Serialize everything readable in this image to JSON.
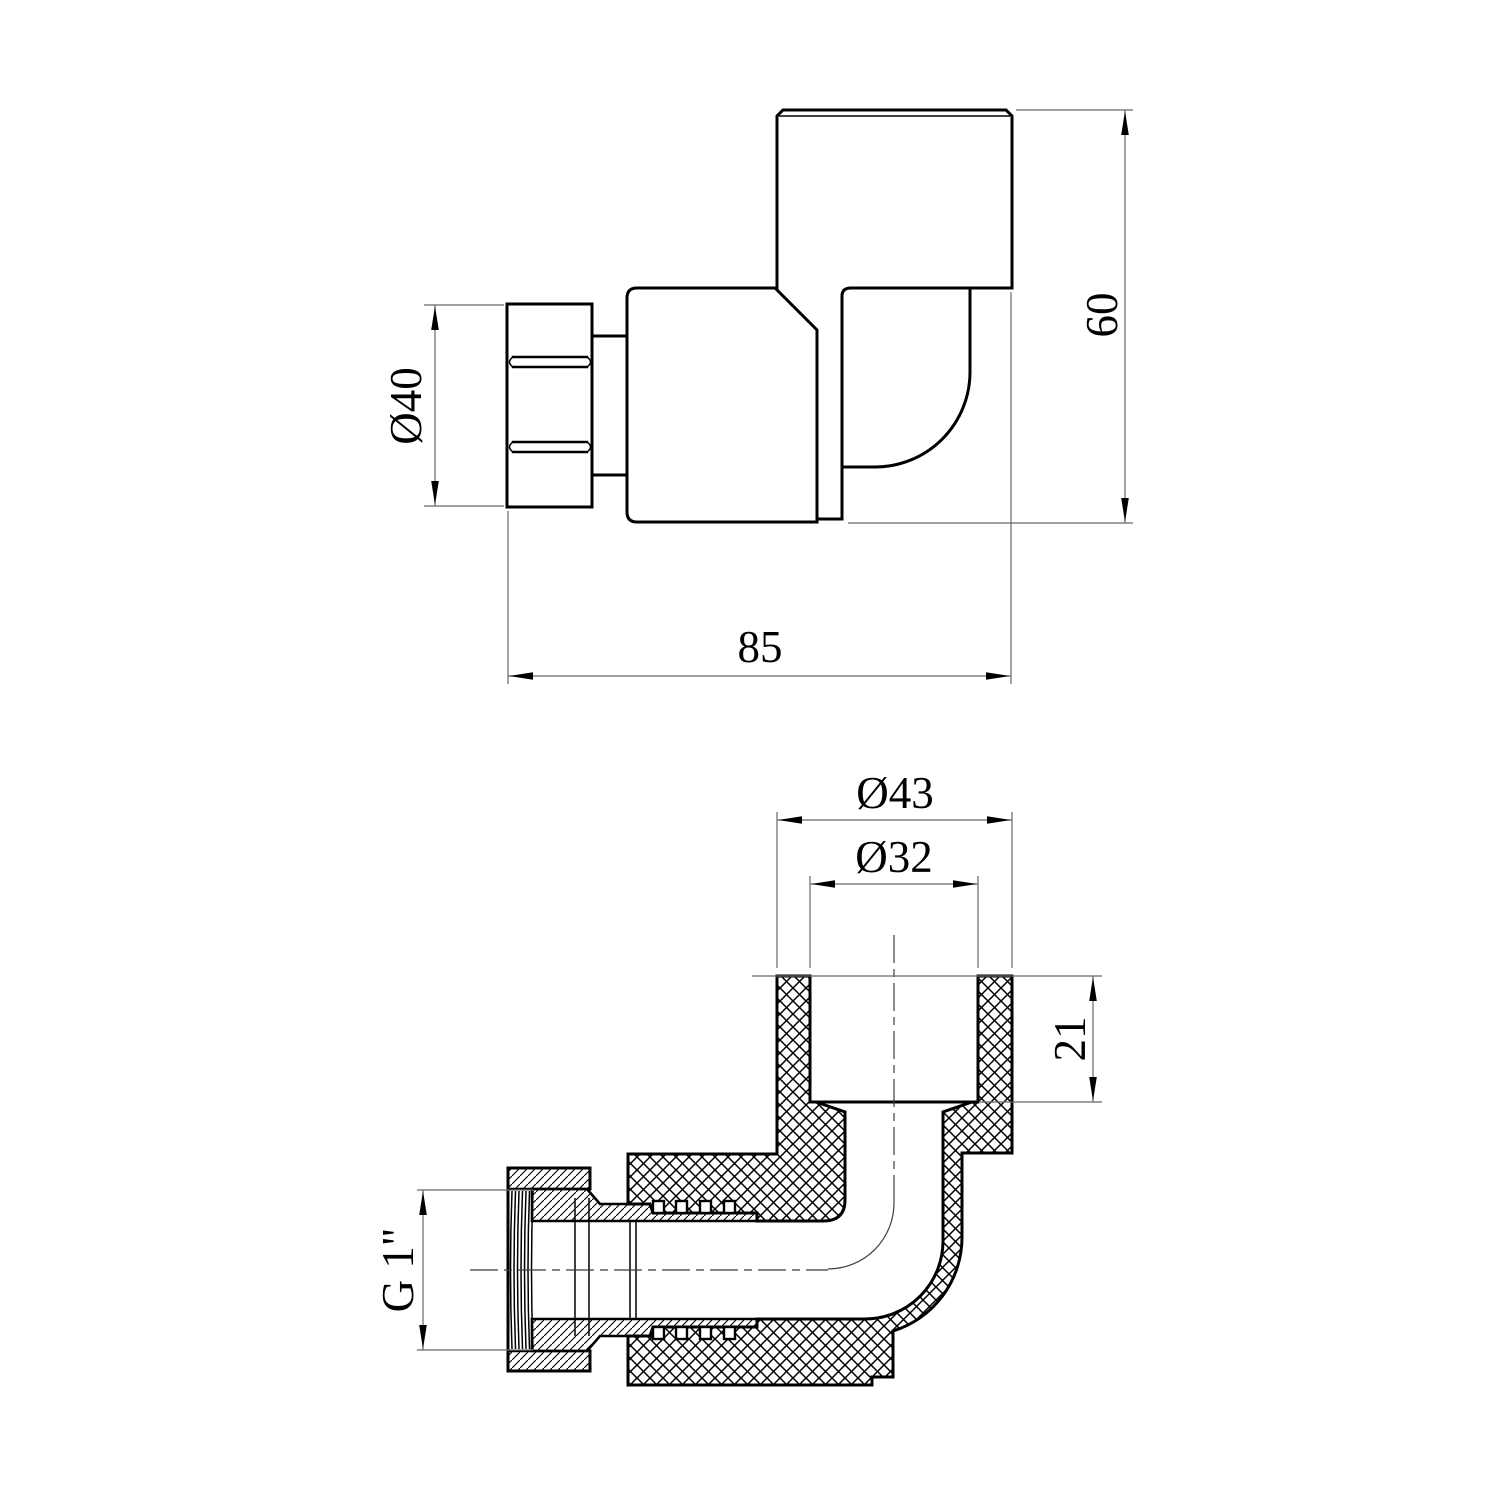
{
  "drawing": {
    "kind": "technical drawing - 90 degree elbow pipe fitting with union nut, two views",
    "colors": {
      "line": "#000000",
      "thin_line": "#686868",
      "background": "#ffffff"
    },
    "views": {
      "side": {
        "label": "side-view",
        "dims": {
          "nut_od": "Ø40",
          "height": "60",
          "length": "85"
        }
      },
      "section": {
        "label": "section-view",
        "dims": {
          "socket_od": "Ø43",
          "socket_id": "Ø32",
          "socket_depth": "21",
          "thread": "G 1\""
        }
      }
    }
  }
}
